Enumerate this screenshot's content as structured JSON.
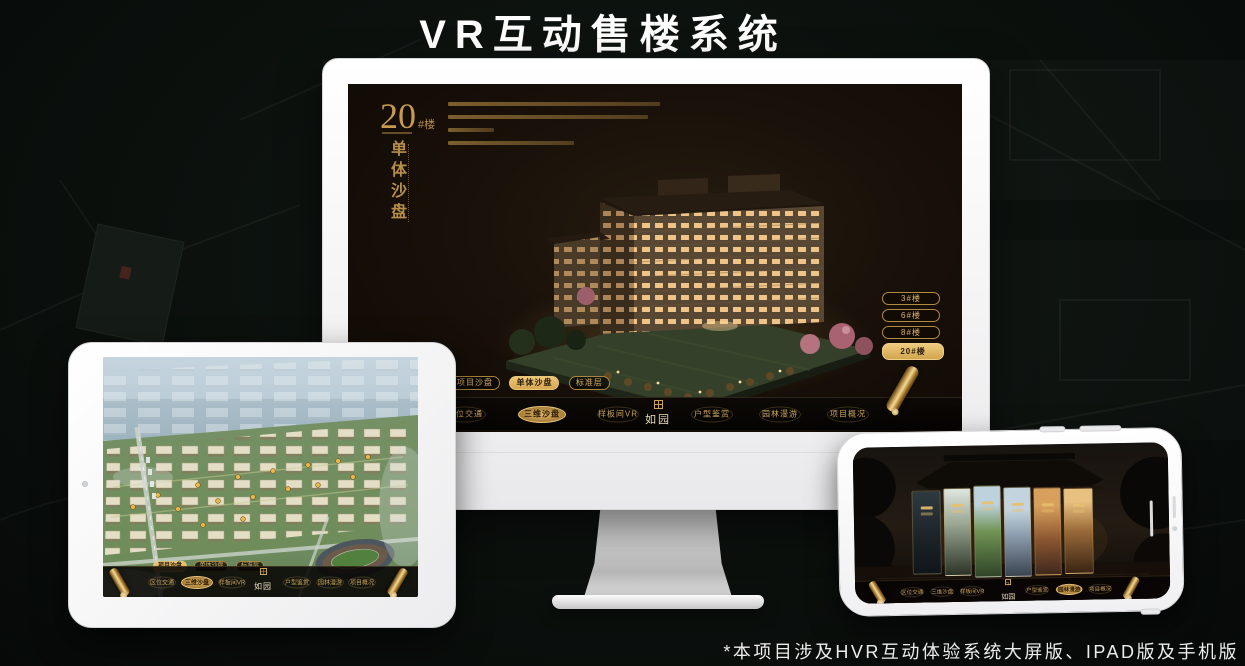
{
  "title": "VR互动售楼系统",
  "footnote": "*本项目涉及HVR互动体验系统大屏版、IPAD版及手机版",
  "colors": {
    "gold": "#c9a45c",
    "gold_bright": "#e3b96b",
    "screen_bg": "#17110b",
    "nav_bg": "#0a0805",
    "title_text": "#ffffff"
  },
  "icons": {
    "scroll": "gold-scroll",
    "seal": "square-seal-stamp",
    "camera": "front-camera-dot"
  },
  "monitor": {
    "headline": {
      "number": "20",
      "suffix": "#楼",
      "subtitle": "单体沙盘"
    },
    "floor_buttons": [
      {
        "label": "3#楼",
        "selected": false
      },
      {
        "label": "6#楼",
        "selected": false
      },
      {
        "label": "8#楼",
        "selected": false
      },
      {
        "label": "20#楼",
        "selected": true
      }
    ],
    "mode_tabs": [
      {
        "label": "项目沙盘",
        "selected": false
      },
      {
        "label": "单体沙盘",
        "selected": true
      },
      {
        "label": "标准层",
        "selected": false
      }
    ],
    "nav": {
      "logo": "如园",
      "items": [
        {
          "label": "区位交通",
          "selected": false
        },
        {
          "label": "三维沙盘",
          "selected": true
        },
        {
          "label": "样板间VR",
          "selected": false
        },
        {
          "label": "户型鉴赏",
          "selected": false
        },
        {
          "label": "园林漫游",
          "selected": false
        },
        {
          "label": "项目概况",
          "selected": false
        }
      ]
    }
  },
  "ipad": {
    "mode_tabs": [
      {
        "label": "项目沙盘",
        "selected": true
      },
      {
        "label": "单体沙盘",
        "selected": false
      },
      {
        "label": "标准层",
        "selected": false
      }
    ],
    "nav": {
      "logo": "如园",
      "items": [
        {
          "label": "区位交通",
          "selected": false
        },
        {
          "label": "三维沙盘",
          "selected": true
        },
        {
          "label": "样板间VR",
          "selected": false
        },
        {
          "label": "户型鉴赏",
          "selected": false
        },
        {
          "label": "园林漫游",
          "selected": false
        },
        {
          "label": "项目概况",
          "selected": false
        }
      ]
    }
  },
  "phone": {
    "nav": {
      "logo": "如园",
      "items": [
        {
          "label": "区位交通",
          "selected": false
        },
        {
          "label": "三维沙盘",
          "selected": false
        },
        {
          "label": "样板间VR",
          "selected": false
        },
        {
          "label": "户型鉴赏",
          "selected": false
        },
        {
          "label": "园林漫游",
          "selected": true
        },
        {
          "label": "项目概况",
          "selected": false
        }
      ]
    }
  }
}
